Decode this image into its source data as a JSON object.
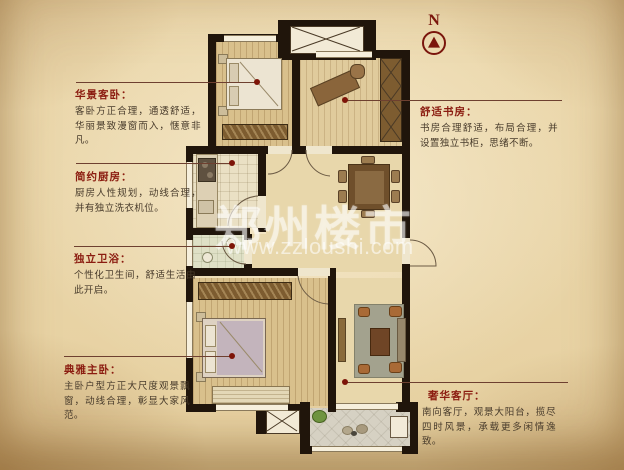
{
  "compass": {
    "label": "N"
  },
  "watermark": {
    "brand": "郑州楼市",
    "url": "www.zzloushi.com"
  },
  "annotations": [
    {
      "id": "guest-bedroom",
      "title": "华景客卧：",
      "body": "客卧方正合理，通透舒适，华丽景致漫窗而入，惬意非凡。"
    },
    {
      "id": "kitchen",
      "title": "简约厨房：",
      "body": "厨房人性规划，动线合理，并有独立洗衣机位。"
    },
    {
      "id": "bathroom",
      "title": "独立卫浴：",
      "body": "个性化卫生间，舒适生活由此开启。"
    },
    {
      "id": "master-bedroom",
      "title": "典雅主卧：",
      "body": "主卧户型方正大尺度观景飘窗，动线合理，彰显大家风范。"
    },
    {
      "id": "study",
      "title": "舒适书房：",
      "body": "书房合理舒适，布局合理，并设置独立书柜，思绪不断。"
    },
    {
      "id": "living-room",
      "title": "奢华客厅：",
      "body": "南向客厅，观景大阳台，揽尽四时风景，承载更多闲情逸致。"
    }
  ],
  "colors": {
    "title": "#8b1c10",
    "body_text": "#483b2b",
    "leader_line": "#6e4030",
    "marker_dot": "#7d1408",
    "wall": "#20150b",
    "compass": "#7a150c",
    "background": "#e9d5a7"
  }
}
